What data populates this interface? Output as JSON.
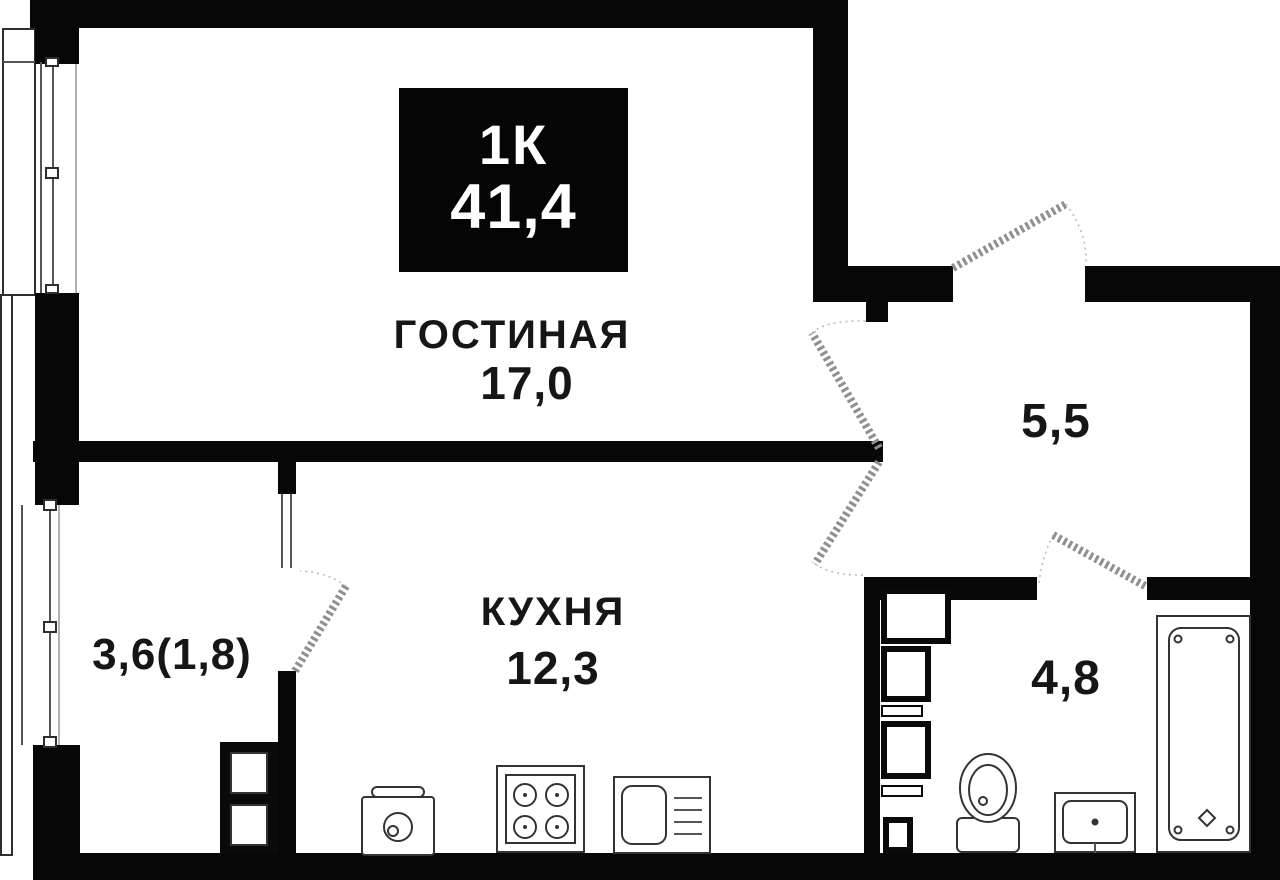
{
  "plan": {
    "badge": {
      "type": "1К",
      "area": "41,4"
    },
    "rooms": {
      "living": {
        "name": "ГОСТИНАЯ",
        "area": "17,0"
      },
      "kitchen": {
        "name": "КУХНЯ",
        "area": "12,3"
      },
      "balcony": {
        "area": "3,6(1,8)"
      },
      "hallway": {
        "area": "5,5"
      },
      "bathroom": {
        "area": "4,8"
      }
    }
  }
}
